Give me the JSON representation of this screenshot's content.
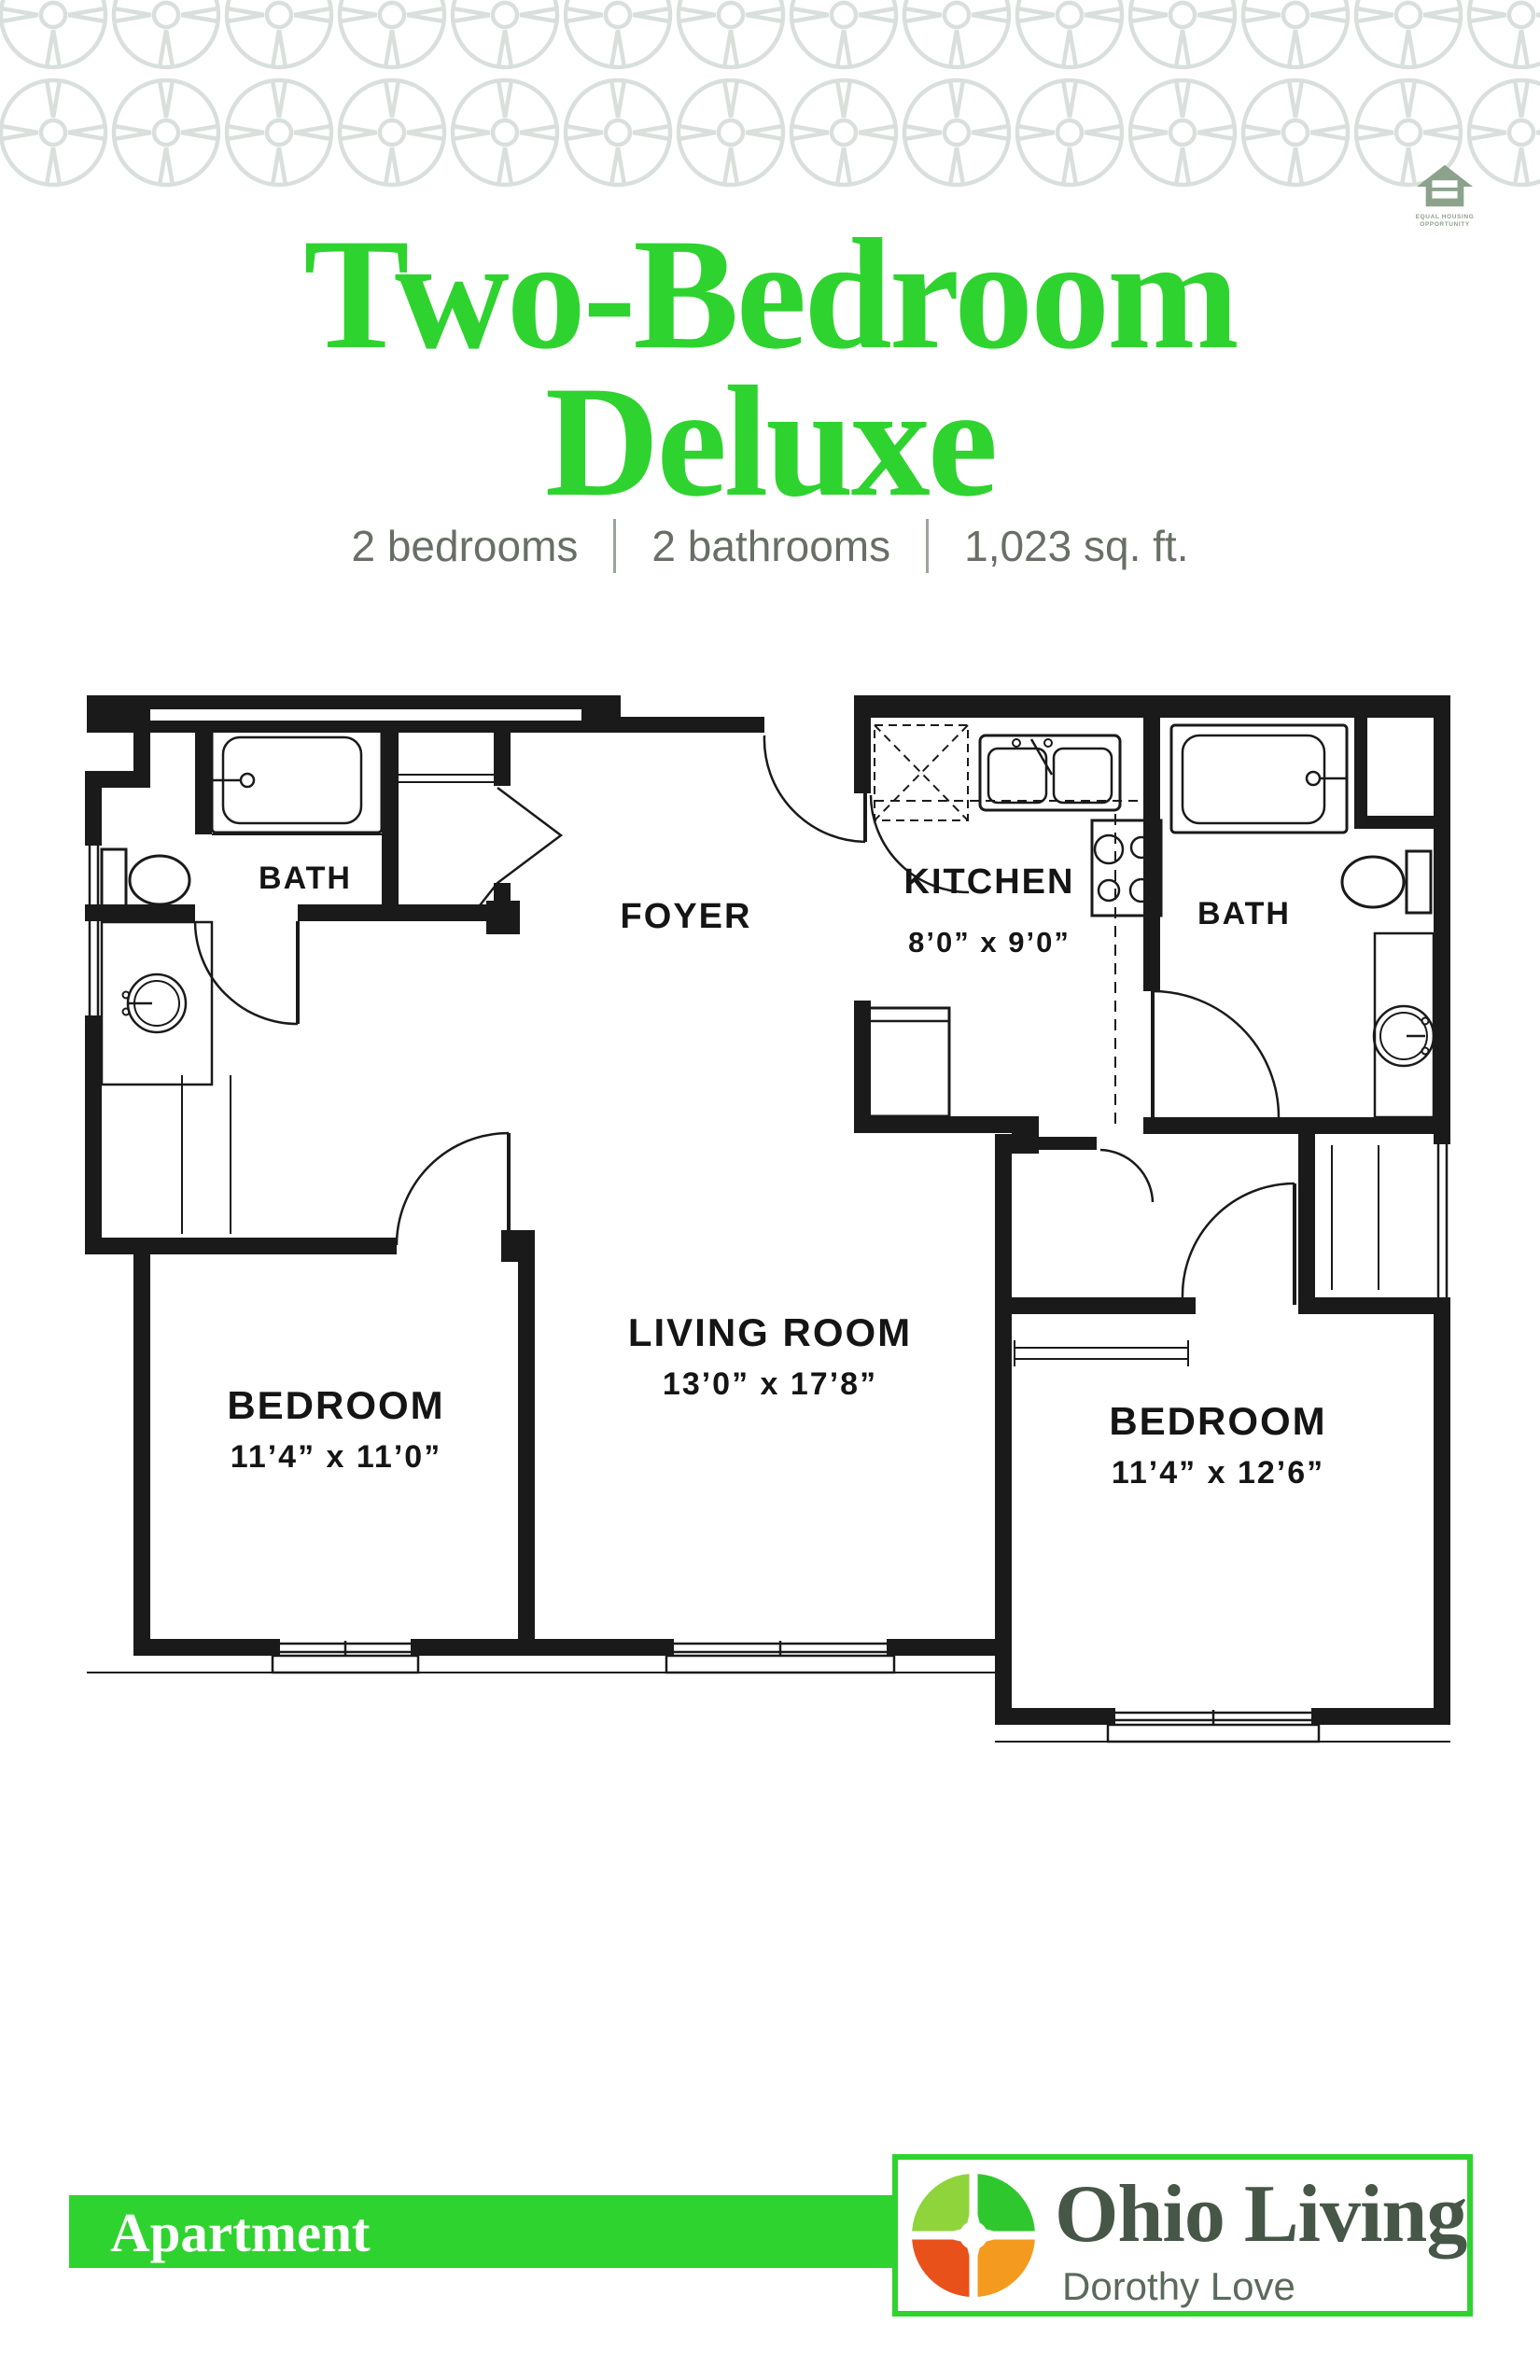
{
  "header": {
    "pattern_color": "#d9e0dc",
    "equal_housing": {
      "line1": "EQUAL HOUSING",
      "line2": "OPPORTUNITY",
      "color": "#8ca28c"
    }
  },
  "title": {
    "line1": "Two-Bedroom",
    "line2": "Deluxe",
    "color": "#2fd32f"
  },
  "summary": {
    "items": [
      "2 bedrooms",
      "2 bathrooms",
      "1,023 sq. ft."
    ],
    "text_color": "#687066"
  },
  "floor_plan": {
    "labels": {
      "bath_left": "BATH",
      "foyer": "FOYER",
      "kitchen": "KITCHEN",
      "kitchen_dims": "8’0” x 9’0”",
      "bath_right": "BATH",
      "bedroom_left": "BEDROOM",
      "bedroom_left_dims": "11’4” x 11’0”",
      "living": "LIVING ROOM",
      "living_dims": "13’0” x 17’8”",
      "bedroom_right": "BEDROOM",
      "bedroom_right_dims": "11’4” x 12’6”"
    }
  },
  "footer": {
    "unit_type": "Apartment",
    "banner_color": "#2fd32f",
    "brand": {
      "name": "Ohio Living",
      "community": "Dorothy Love",
      "name_color": "#475747",
      "community_color": "#5a6a5c",
      "border_color": "#2fd32f",
      "logo_colors": {
        "top_left": "#8fd43a",
        "top_right": "#2ec82e",
        "bottom_left": "#e8521a",
        "bottom_right": "#f49b1f"
      }
    }
  }
}
